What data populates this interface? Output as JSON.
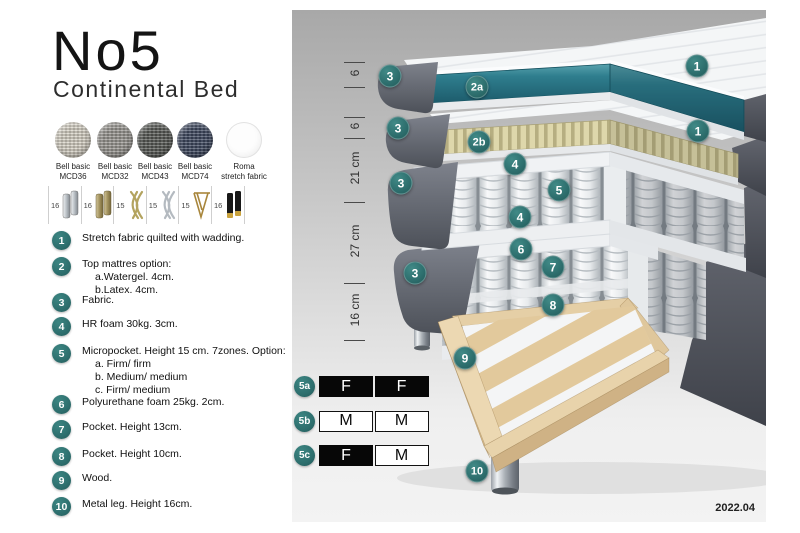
{
  "header": {
    "title": "No5",
    "subtitle": "Continental Bed"
  },
  "fabrics": [
    {
      "name": "Bell basic",
      "code": "MCD36",
      "color": "#d8d3c6"
    },
    {
      "name": "Bell basic",
      "code": "MCD32",
      "color": "#9b9893"
    },
    {
      "name": "Bell basic",
      "code": "MCD43",
      "color": "#595b57"
    },
    {
      "name": "Bell basic",
      "code": "MCD74",
      "color": "#3f4961"
    },
    {
      "name": "Roma",
      "code": "stretch fabric",
      "color": "#fdfdfd"
    }
  ],
  "legs": [
    {
      "height": "16",
      "style": "cylinder-silver"
    },
    {
      "height": "16",
      "style": "cylinder-brass"
    },
    {
      "height": "15",
      "style": "twist-gold"
    },
    {
      "height": "15",
      "style": "twist-silver"
    },
    {
      "height": "15",
      "style": "hairpin-gold"
    },
    {
      "height": "16",
      "style": "cylinder-black-gold"
    }
  ],
  "legend": [
    {
      "num": "1",
      "text": "Stretch fabric quilted with wadding.",
      "subs": []
    },
    {
      "num": "2",
      "text": "Top mattres option:",
      "subs": [
        "a.Watergel. 4cm.",
        "b.Latex. 4cm."
      ]
    },
    {
      "num": "3",
      "text": "Fabric.",
      "subs": []
    },
    {
      "num": "4",
      "text": "HR foam 30kg. 3cm.",
      "subs": []
    },
    {
      "num": "5",
      "text": "Micropocket. Height 15 cm. 7zones. Option:",
      "subs": [
        "a. Firm/ firm",
        "b. Medium/ medium",
        "c. Firm/ medium"
      ]
    },
    {
      "num": "6",
      "text": "Polyurethane foam 25kg. 2cm.",
      "subs": []
    },
    {
      "num": "7",
      "text": "Pocket. Height 13cm.",
      "subs": []
    },
    {
      "num": "8",
      "text": "Pocket. Height 10cm.",
      "subs": []
    },
    {
      "num": "9",
      "text": "Wood.",
      "subs": []
    },
    {
      "num": "10",
      "text": "Metal leg. Height 16cm.",
      "subs": []
    }
  ],
  "diagram": {
    "dimensions": [
      "6",
      "6",
      "21 cm",
      "27 cm",
      "16 cm"
    ],
    "badges": [
      {
        "label": "1",
        "x": 405,
        "y": 56
      },
      {
        "label": "1",
        "x": 406,
        "y": 121
      },
      {
        "label": "2a",
        "x": 185,
        "y": 77
      },
      {
        "label": "2b",
        "x": 187,
        "y": 132
      },
      {
        "label": "3",
        "x": 98,
        "y": 66
      },
      {
        "label": "3",
        "x": 106,
        "y": 118
      },
      {
        "label": "3",
        "x": 109,
        "y": 173
      },
      {
        "label": "3",
        "x": 123,
        "y": 263
      },
      {
        "label": "4",
        "x": 223,
        "y": 154
      },
      {
        "label": "5",
        "x": 267,
        "y": 180
      },
      {
        "label": "4",
        "x": 228,
        "y": 207
      },
      {
        "label": "6",
        "x": 229,
        "y": 239
      },
      {
        "label": "7",
        "x": 261,
        "y": 257
      },
      {
        "label": "8",
        "x": 261,
        "y": 295
      },
      {
        "label": "9",
        "x": 173,
        "y": 348
      },
      {
        "label": "10",
        "x": 185,
        "y": 461
      }
    ],
    "version": "2022.04"
  },
  "firmness": [
    {
      "badge": "5a",
      "cells": [
        {
          "text": "F",
          "fill": "black"
        },
        {
          "text": "F",
          "fill": "black"
        }
      ]
    },
    {
      "badge": "5b",
      "cells": [
        {
          "text": "M",
          "fill": "white"
        },
        {
          "text": "M",
          "fill": "white"
        }
      ]
    },
    {
      "badge": "5c",
      "cells": [
        {
          "text": "F",
          "fill": "black"
        },
        {
          "text": "M",
          "fill": "white"
        }
      ]
    }
  ],
  "colors": {
    "badge_teal": "#2d6e6d",
    "gel_teal": "#2f7e8e",
    "latex": "#d9d2a5",
    "wood": "#e8d3ab"
  }
}
